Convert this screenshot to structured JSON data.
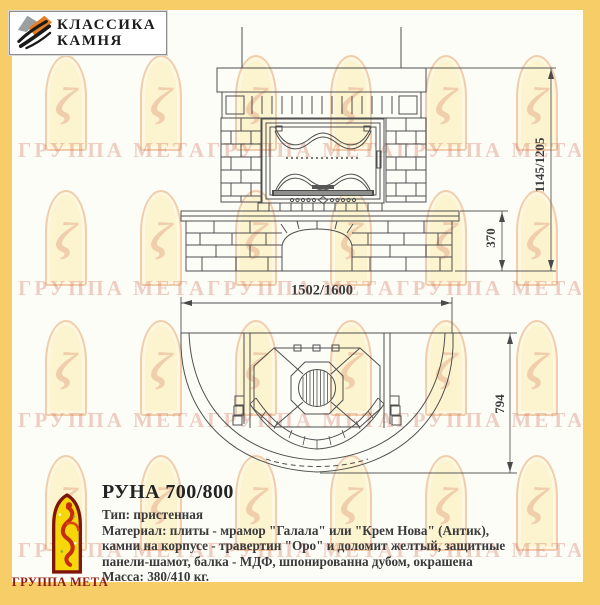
{
  "page": {
    "border_color": "#f7cd67",
    "paper_color": "#fdfdf8"
  },
  "header_logo": {
    "line1": "КЛАССИКА",
    "line2": "КАМНЯ",
    "icon_colors": {
      "gray": "#9aa0a2",
      "orange": "#e57f25",
      "black": "#1b1b1b"
    }
  },
  "watermark": {
    "row_text": "ГРУППА МЕТАГРУППА МЕТАГРУППА МЕТА",
    "arch_glyph": "ζ"
  },
  "drawing": {
    "dims": {
      "height": "1145/1205",
      "hearth_height": "370",
      "width": "1502/1600",
      "depth": "794"
    }
  },
  "meta_logo": {
    "caption": "ГРУППА МЕТА",
    "red": "#8e1c10",
    "yellow": "#f6d70a"
  },
  "product": {
    "title": "РУНА 700/800",
    "type_line": "Тип: пристенная",
    "material_lines": [
      "Материал: плиты - мрамор \"Галала\" или \"Крем Нова\" (Антик),",
      "камни на корпусе - травертин \"Оро\" и доломит желтый, защитные",
      "панели-шамот, балка - МДФ, шпонированна дубом, окрашена"
    ],
    "mass_line": "Масса: 380/410 кг."
  }
}
